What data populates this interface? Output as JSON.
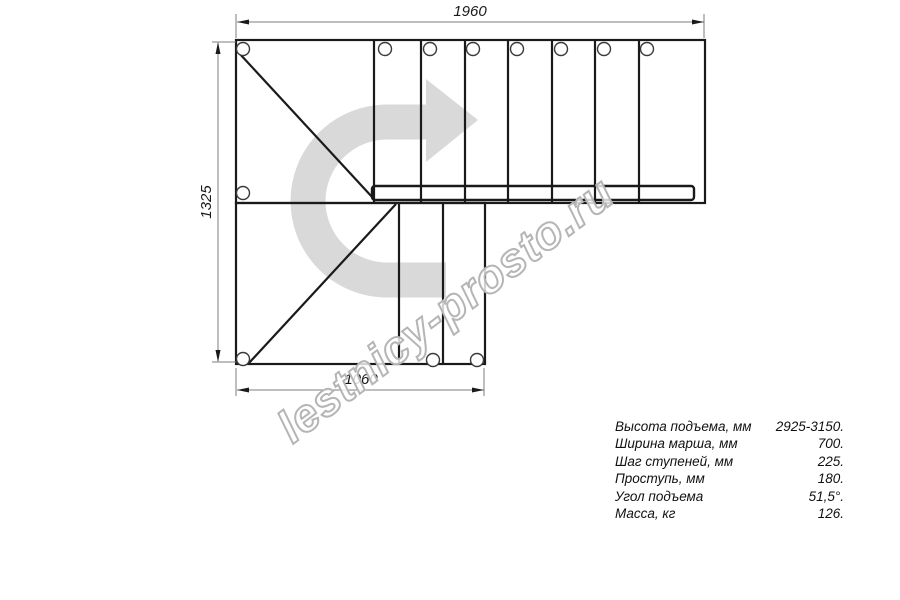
{
  "drawing": {
    "title": "stair-plan-top-view",
    "dimension_labels": {
      "top_width": "1960",
      "left_height": "1325",
      "bottom_width": "1060"
    },
    "watermark": "lestnicy-prosto.ru",
    "colors": {
      "line": "#1a1a1a",
      "dimension_line": "#7d7d7d",
      "arrow_fill": "#d9d9d9",
      "watermark_stroke": "#b5b5b5"
    }
  },
  "specs": {
    "rows": [
      {
        "label": "Высота подъема, мм",
        "value": "2925-3150."
      },
      {
        "label": "Ширина марша, мм",
        "value": "700."
      },
      {
        "label": "Шаг ступеней, мм",
        "value": "225."
      },
      {
        "label": "Проступь, мм",
        "value": "180."
      },
      {
        "label": "Угол подъема",
        "value": "51,5°."
      },
      {
        "label": "Масса, кг",
        "value": "126."
      }
    ]
  }
}
